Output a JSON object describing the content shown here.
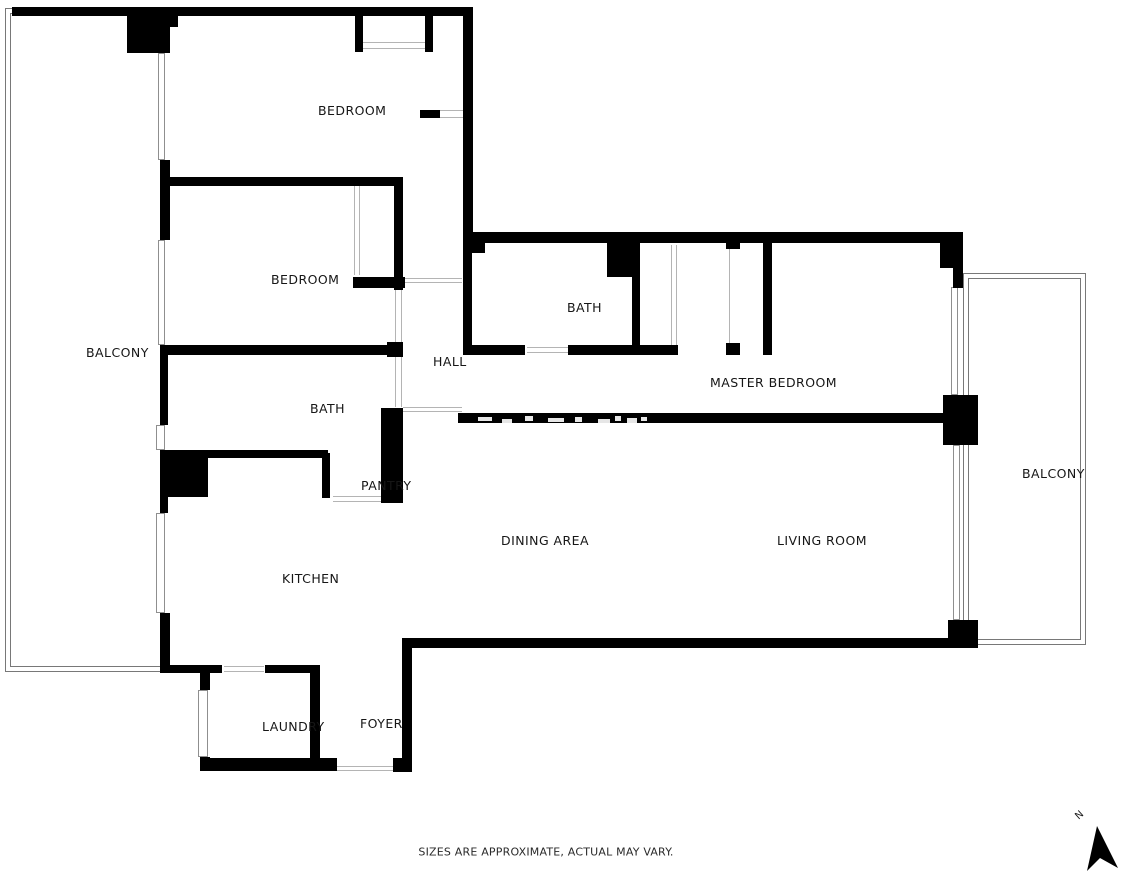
{
  "meta": {
    "canvas_width": 1122,
    "canvas_height": 874,
    "background_color": "#ffffff",
    "wall_color": "#000000",
    "window_line_color": "#8f8f8f",
    "door_line_color": "#b4b4b4",
    "balcony_outline_color": "#787878"
  },
  "footer": {
    "disclaimer": "SIZES ARE APPROXIMATE, ACTUAL MAY VARY."
  },
  "north": {
    "label": "N"
  },
  "floorplan": {
    "rooms": [
      {
        "name": "bedroom-1",
        "label": "BEDROOM",
        "x": 318,
        "y": 103
      },
      {
        "name": "bedroom-2",
        "label": "BEDROOM",
        "x": 271,
        "y": 272
      },
      {
        "name": "balcony-left",
        "label": "BALCONY",
        "x": 86,
        "y": 345
      },
      {
        "name": "bath-master",
        "label": "BATH",
        "x": 567,
        "y": 300
      },
      {
        "name": "hall",
        "label": "HALL",
        "x": 433,
        "y": 354
      },
      {
        "name": "master-bedroom",
        "label": "MASTER BEDROOM",
        "x": 710,
        "y": 375
      },
      {
        "name": "bath",
        "label": "BATH",
        "x": 310,
        "y": 401
      },
      {
        "name": "pantry",
        "label": "PANTRY",
        "x": 361,
        "y": 478
      },
      {
        "name": "dining-area",
        "label": "DINING AREA",
        "x": 501,
        "y": 533
      },
      {
        "name": "living-room",
        "label": "LIVING ROOM",
        "x": 777,
        "y": 533
      },
      {
        "name": "balcony-right",
        "label": "BALCONY",
        "x": 1022,
        "y": 466
      },
      {
        "name": "kitchen",
        "label": "KITCHEN",
        "x": 282,
        "y": 571
      },
      {
        "name": "laundry",
        "label": "LAUNDRY",
        "x": 262,
        "y": 719
      },
      {
        "name": "foyer",
        "label": "FOYER",
        "x": 360,
        "y": 716
      }
    ],
    "walls": [
      [
        12,
        7,
        461,
        9
      ],
      [
        127,
        15,
        43,
        38
      ],
      [
        170,
        15,
        8,
        12
      ],
      [
        463,
        7,
        10,
        226
      ],
      [
        355,
        16,
        8,
        36
      ],
      [
        425,
        16,
        8,
        36
      ],
      [
        420,
        110,
        20,
        8
      ],
      [
        160,
        160,
        10,
        80
      ],
      [
        167,
        177,
        236,
        9
      ],
      [
        394,
        177,
        9,
        113
      ],
      [
        353,
        277,
        52,
        11
      ],
      [
        160,
        345,
        8,
        80
      ],
      [
        160,
        345,
        230,
        10
      ],
      [
        387,
        342,
        16,
        15
      ],
      [
        160,
        450,
        48,
        47
      ],
      [
        208,
        450,
        120,
        8
      ],
      [
        322,
        453,
        8,
        45
      ],
      [
        381,
        408,
        22,
        95
      ],
      [
        463,
        232,
        9,
        123
      ],
      [
        463,
        232,
        500,
        11
      ],
      [
        468,
        232,
        17,
        21
      ],
      [
        940,
        233,
        23,
        35
      ],
      [
        953,
        268,
        10,
        20
      ],
      [
        607,
        240,
        33,
        37
      ],
      [
        632,
        277,
        8,
        68
      ],
      [
        463,
        345,
        62,
        10
      ],
      [
        568,
        345,
        64,
        10
      ],
      [
        632,
        345,
        46,
        10
      ],
      [
        726,
        240,
        14,
        9
      ],
      [
        726,
        343,
        14,
        12
      ],
      [
        763,
        240,
        9,
        115
      ],
      [
        458,
        413,
        485,
        10
      ],
      [
        943,
        395,
        35,
        50
      ],
      [
        948,
        620,
        30,
        28
      ],
      [
        402,
        638,
        548,
        10
      ],
      [
        402,
        638,
        10,
        134
      ],
      [
        160,
        665,
        50,
        8
      ],
      [
        210,
        665,
        12,
        8
      ],
      [
        265,
        665,
        55,
        8
      ],
      [
        310,
        665,
        10,
        105
      ],
      [
        200,
        673,
        10,
        17
      ],
      [
        200,
        757,
        10,
        13
      ],
      [
        200,
        758,
        137,
        13
      ],
      [
        393,
        758,
        19,
        14
      ],
      [
        160,
        497,
        8,
        16
      ],
      [
        160,
        613,
        10,
        59
      ]
    ],
    "windows": [
      [
        158,
        53,
        7,
        107
      ],
      [
        158,
        240,
        7,
        105
      ],
      [
        156,
        425,
        9,
        25
      ],
      [
        156,
        513,
        9,
        100
      ],
      [
        198,
        690,
        10,
        67
      ],
      [
        951,
        287,
        7,
        108
      ],
      [
        953,
        445,
        7,
        175
      ]
    ],
    "door_lines": [
      [
        363,
        42,
        62,
        1
      ],
      [
        363,
        48,
        62,
        1
      ],
      [
        354,
        186,
        1,
        89
      ],
      [
        359,
        186,
        1,
        89
      ],
      [
        403,
        278,
        59,
        1
      ],
      [
        403,
        282,
        59,
        1
      ],
      [
        395,
        290,
        1,
        52
      ],
      [
        401,
        290,
        1,
        52
      ],
      [
        395,
        357,
        1,
        50
      ],
      [
        401,
        357,
        1,
        50
      ],
      [
        403,
        407,
        59,
        1
      ],
      [
        403,
        411,
        59,
        1
      ],
      [
        527,
        347,
        41,
        1
      ],
      [
        527,
        352,
        41,
        1
      ],
      [
        671,
        245,
        1,
        100
      ],
      [
        676,
        245,
        1,
        100
      ],
      [
        729,
        249,
        1,
        94
      ],
      [
        333,
        496,
        60,
        1
      ],
      [
        333,
        501,
        60,
        1
      ],
      [
        224,
        666,
        40,
        1
      ],
      [
        224,
        671,
        40,
        1
      ],
      [
        337,
        766,
        56,
        1
      ],
      [
        337,
        770,
        56,
        1
      ],
      [
        440,
        110,
        23,
        1
      ],
      [
        440,
        117,
        23,
        1
      ]
    ],
    "balcony_outlines": [
      [
        5,
        8,
        160,
        664
      ],
      [
        10,
        13,
        151,
        654
      ],
      [
        963,
        273,
        123,
        372
      ],
      [
        968,
        278,
        113,
        362
      ]
    ],
    "wall_artifacts": [
      [
        478,
        417,
        14,
        4
      ],
      [
        502,
        419,
        10,
        4
      ],
      [
        525,
        416,
        8,
        5
      ],
      [
        548,
        418,
        16,
        4
      ],
      [
        575,
        417,
        7,
        5
      ],
      [
        598,
        419,
        12,
        4
      ],
      [
        615,
        416,
        6,
        5
      ],
      [
        627,
        418,
        10,
        5
      ],
      [
        641,
        417,
        6,
        4
      ]
    ]
  }
}
